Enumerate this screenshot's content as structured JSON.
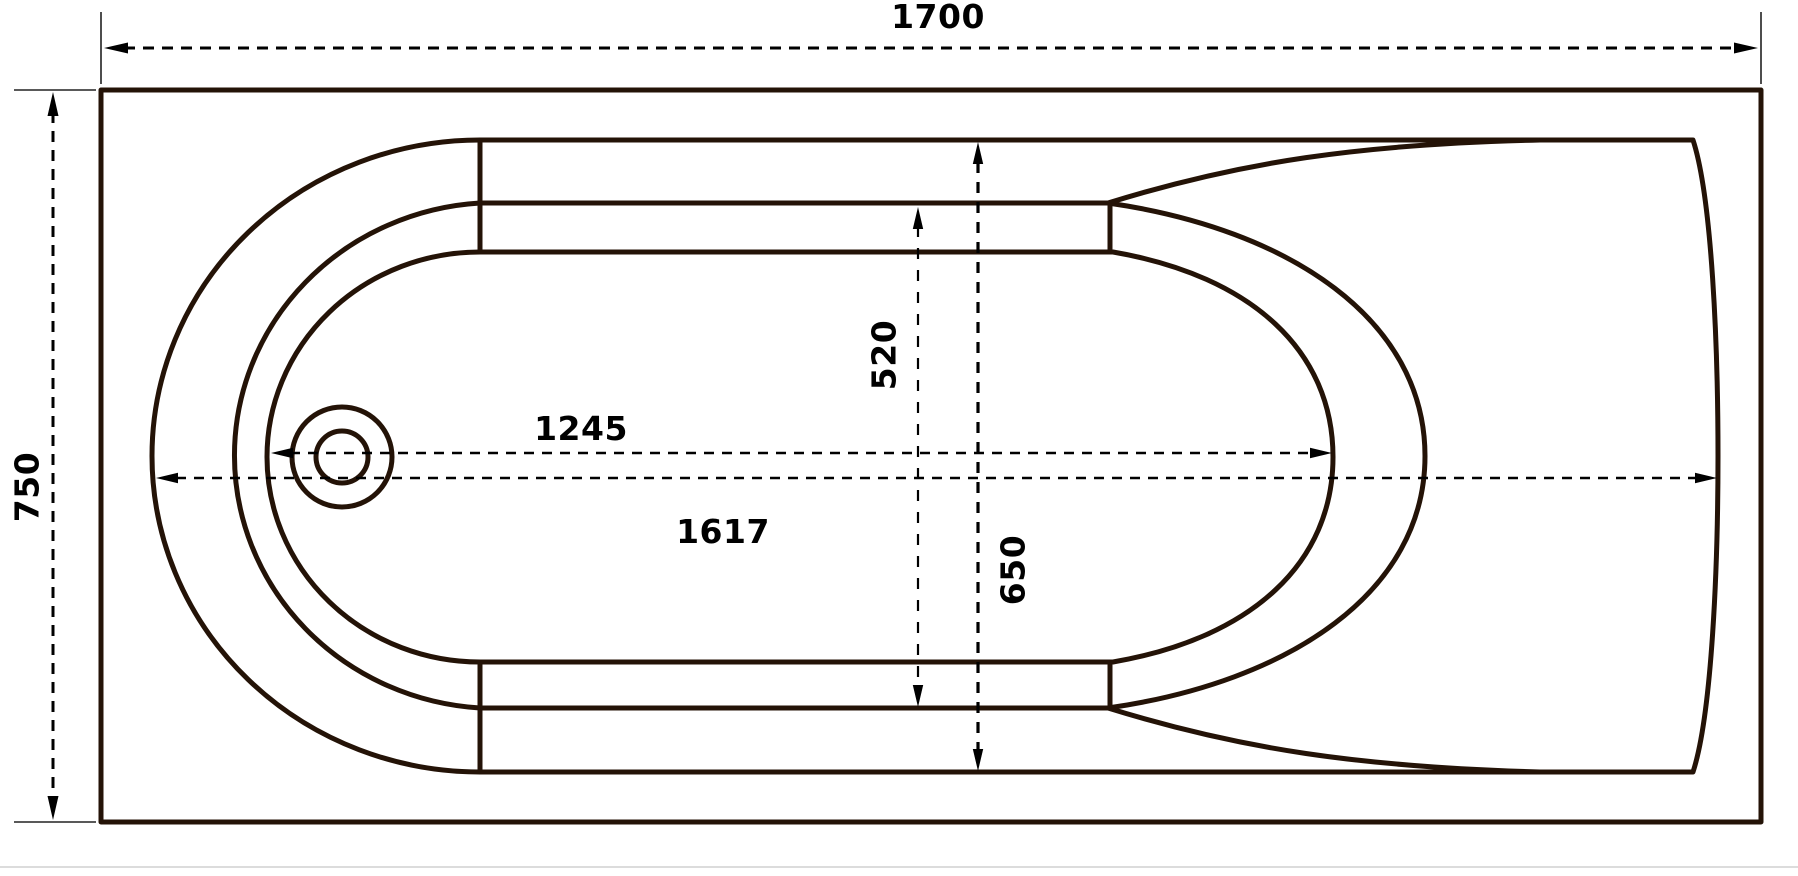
{
  "drawing": {
    "type": "bathtub-top-view-technical-drawing",
    "colors": {
      "outline": "#241307",
      "dimension": "#000000",
      "background": "#ffffff",
      "divider": "#dcdcdc"
    },
    "dimensions": {
      "overall_length": {
        "label": "1700"
      },
      "overall_width": {
        "label": "750"
      },
      "floor_length": {
        "label": "1245"
      },
      "inner_length": {
        "label": "1617"
      },
      "floor_width": {
        "label": "520"
      },
      "inner_width": {
        "label": "650"
      }
    }
  }
}
